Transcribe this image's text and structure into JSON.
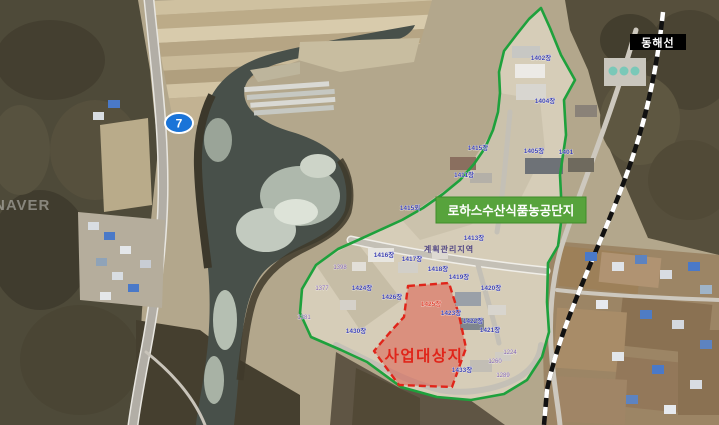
{
  "map": {
    "watermark": "NAVER",
    "route_shield": {
      "number": "7",
      "bg": "#1a74d8",
      "border": "#ffffff"
    },
    "railway_label": {
      "text": "동해선",
      "bg": "#000000",
      "fg": "#ffffff"
    },
    "complex_label": {
      "text": "로하스수산식품농공단지",
      "bg": "#57a33c",
      "fg": "#ffffff"
    },
    "site_label": {
      "text": "사업대상지",
      "color": "#e0251a"
    },
    "zone_label": {
      "text": "계획관리지역",
      "color": "#453a80"
    },
    "boundary": {
      "color": "#1ea13c"
    },
    "site_outline": {
      "color": "#e0251a",
      "fill": "rgba(225,70,55,0.45)"
    },
    "railway": {
      "colors": [
        "#111111",
        "#ffffff"
      ]
    },
    "parcels": [
      {
        "t": "1402장"
      },
      {
        "t": "1404장"
      },
      {
        "t": "1401"
      },
      {
        "t": "1415장"
      },
      {
        "t": "1405장"
      },
      {
        "t": "1411장"
      },
      {
        "t": "1415외"
      },
      {
        "t": "1413장"
      },
      {
        "t": "1416장"
      },
      {
        "t": "1417장"
      },
      {
        "t": "1418장"
      },
      {
        "t": "1419장"
      },
      {
        "t": "1420장"
      },
      {
        "t": "1424장"
      },
      {
        "t": "1426장"
      },
      {
        "t": "1425장"
      },
      {
        "t": "1423장"
      },
      {
        "t": "1422장"
      },
      {
        "t": "1421장"
      },
      {
        "t": "1430장"
      },
      {
        "t": "1433장"
      },
      {
        "t": "1224"
      },
      {
        "t": "1260"
      },
      {
        "t": "1289"
      },
      {
        "t": "1398"
      },
      {
        "t": "1377"
      },
      {
        "t": "1381"
      }
    ]
  }
}
